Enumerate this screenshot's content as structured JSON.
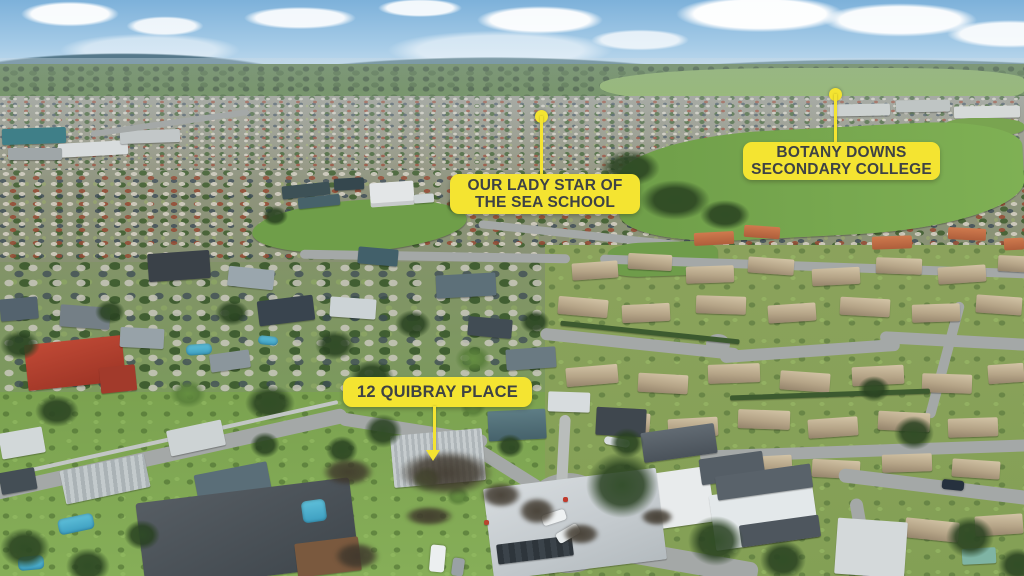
{
  "scene": {
    "type": "aerial-drone-photograph",
    "setting": "suburban neighbourhood with cul-de-sac in foreground",
    "callout_bg_color": "#F4E431",
    "callout_text_color": "#3E4245",
    "marker_color": "#F4E431"
  },
  "callouts": [
    {
      "line1": "OUR LADY STAR OF",
      "line2": "THE SEA SCHOOL",
      "marker": "dot-pin-icon"
    },
    {
      "line1": "BOTANY DOWNS",
      "line2": "SECONDARY COLLEGE",
      "marker": "dot-pin-icon"
    },
    {
      "line1": "12 QUIBRAY PLACE",
      "marker": "arrow-pin-icon"
    }
  ]
}
